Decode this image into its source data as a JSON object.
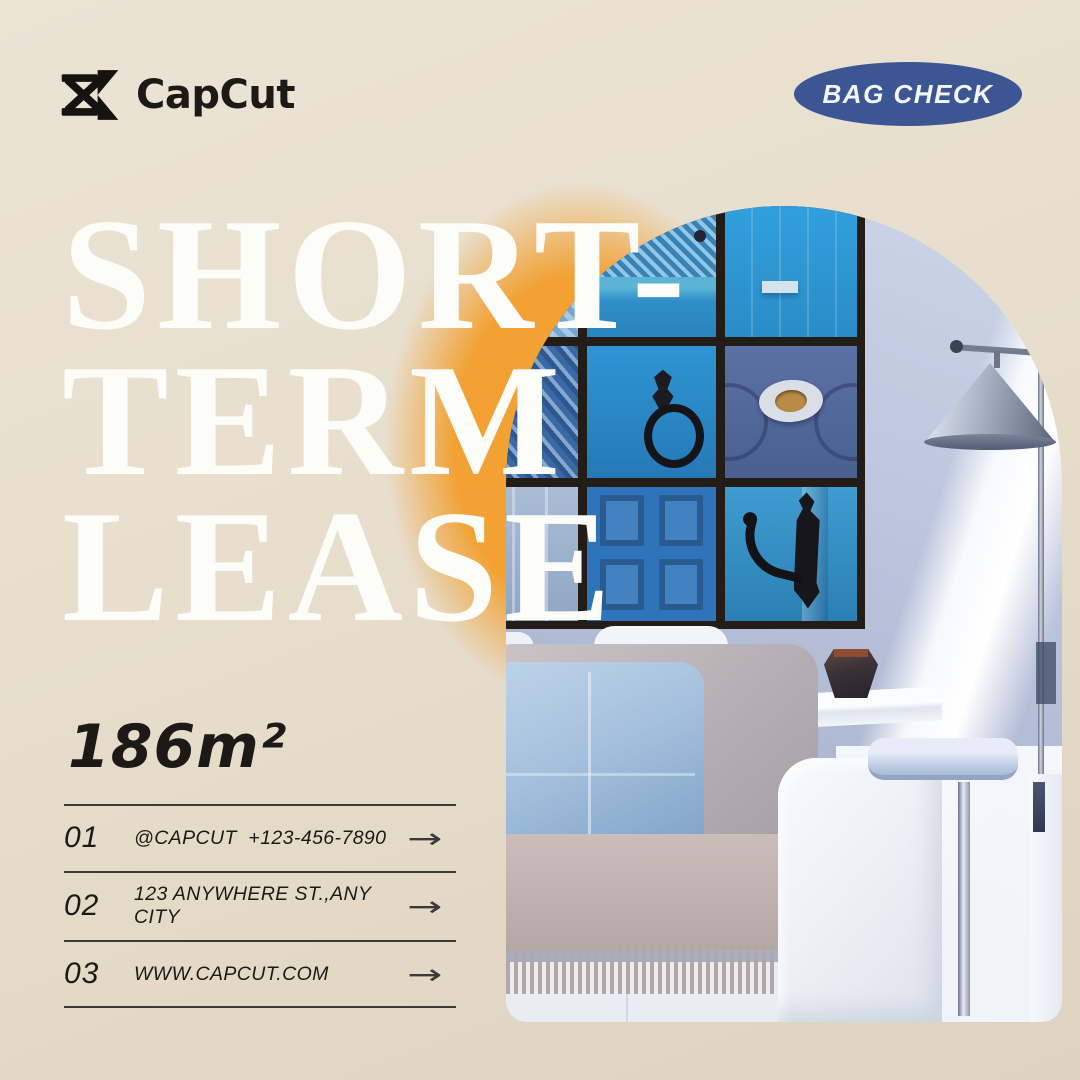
{
  "brand": {
    "name": "CapCut"
  },
  "badge": {
    "label": "BAG CHECK"
  },
  "title": {
    "line1": "SHORT-",
    "line2": "TERM",
    "line3": "LEASE"
  },
  "area": {
    "value": "186m²"
  },
  "contacts": {
    "rows": [
      {
        "num": "01",
        "label": "@CAPCUT  +123-456-7890",
        "arrow": "→"
      },
      {
        "num": "02",
        "label": "123 ANYWHERE ST.,ANY CITY",
        "arrow": "→"
      },
      {
        "num": "03",
        "label": "WWW.CAPCUT.COM",
        "arrow": "→"
      }
    ]
  },
  "photo": {
    "description": "Arched photo of a living room: 3x3 gallery of blue door close-ups on a blue-gray wall, metallic cone floor lamp, white sofa with blue linen pillow, gray back cushion and fringed gray throw, dark faceted vase on white side table, pale blue C-table"
  },
  "theme": {
    "bg": "#e7decd",
    "orange": "#f2a132",
    "badgeBg": "#3c5694",
    "ink": "#1c1a17",
    "titleColor": "#fcfcf8",
    "lineColor": "#3b3a38"
  }
}
